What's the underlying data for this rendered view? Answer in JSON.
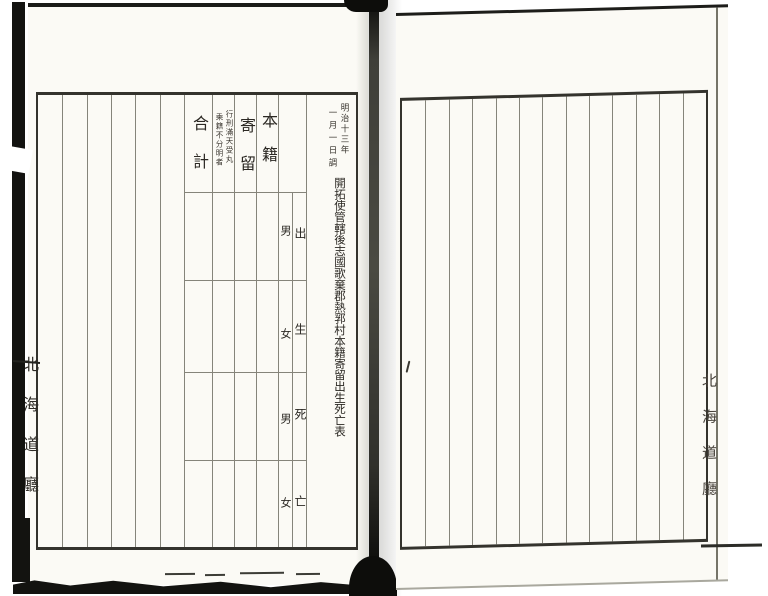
{
  "left_page": {
    "survey_date": [
      "明治十三年",
      "一月一日調"
    ],
    "title": "開拓使管轄後志國歌棄郡熱郛村本籍寄留出生死亡表",
    "headers": {
      "honseki": "本籍",
      "kiryu": "寄留",
      "gokei": "合計"
    },
    "kiryu_note": [
      "行刑滿天受丸",
      "乘籍不分明者"
    ],
    "row_labels": [
      {
        "category": "出",
        "sex": "男"
      },
      {
        "category": "生",
        "sex": "女"
      },
      {
        "category": "死",
        "sex": "男"
      },
      {
        "category": "亡",
        "sex": "女"
      }
    ],
    "empty_column_count": 6
  },
  "right_page": {
    "column_count": 13,
    "ink_mark": "/"
  },
  "edge_stamps": {
    "left": "北海道廳",
    "right": "北海道廳"
  },
  "colors": {
    "paper": "#fbfaf5",
    "rule_line": "#85847a",
    "frame": "#34332d",
    "ink": "#2b2823",
    "edge_black": "#131310"
  }
}
